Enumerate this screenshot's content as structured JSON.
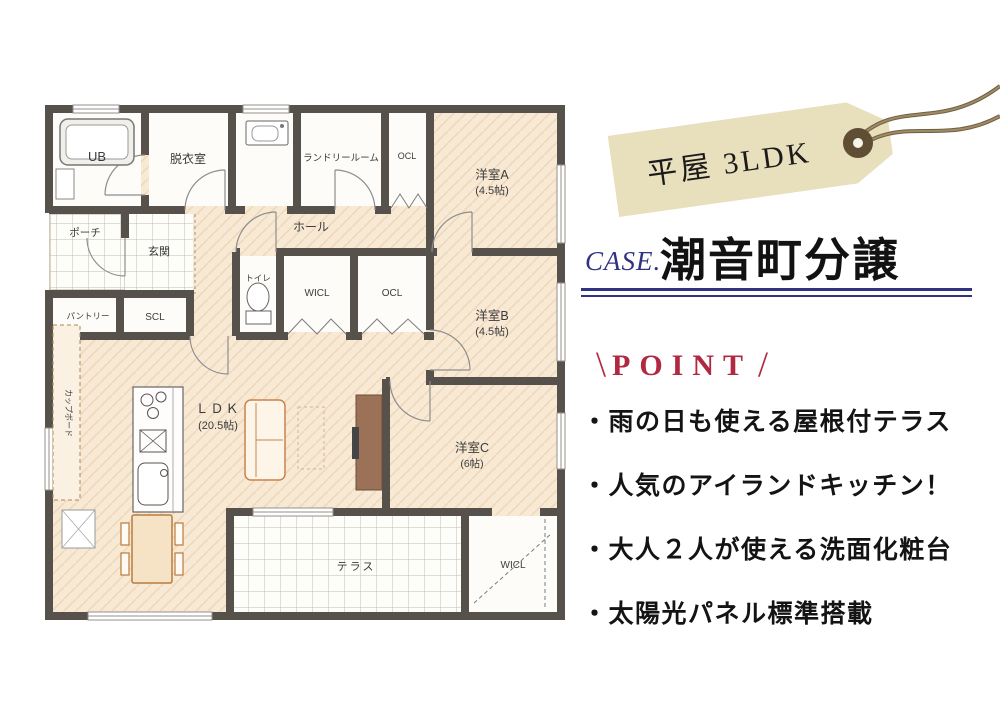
{
  "tag": {
    "label": "平屋 3LDK"
  },
  "heading": {
    "case_label": "CASE.",
    "title": "潮音町分譲"
  },
  "point": {
    "slash_left": "\\",
    "header": "POINT",
    "slash_right": "/",
    "items": [
      "・雨の日も使える屋根付テラス",
      "・人気のアイランドキッチン！",
      "・大人２人が使える洗面化粧台",
      "・太陽光パネル標準搭載"
    ]
  },
  "floorplan": {
    "rooms": {
      "ub": "UB",
      "dressing": "脱衣室",
      "laundry": "ランドリールーム",
      "closet_top": "OCL",
      "room_a": "洋室A",
      "room_a_size": "(4.5帖)",
      "hall": "ホール",
      "porch": "ポーチ",
      "entrance": "玄関",
      "pantry": "パントリー",
      "shoe_closet": "SCL",
      "toilet": "トイレ",
      "wic_mid": "WICL",
      "closet_mid": "OCL",
      "room_b": "洋室B",
      "room_b_size": "(4.5帖)",
      "ldk": "ＬＤＫ",
      "ldk_size": "(20.5帖)",
      "cupboard": "カップボード",
      "room_c": "洋室C",
      "room_c_size": "(6帖)",
      "terrace": "テラス",
      "wic_bottom": "WICL"
    }
  },
  "colors": {
    "wall": "#56514b",
    "floor": "#f8e9d4",
    "accent_red": "#b02940",
    "accent_navy": "#2f3383",
    "tag_beige": "#e8dfbc"
  }
}
